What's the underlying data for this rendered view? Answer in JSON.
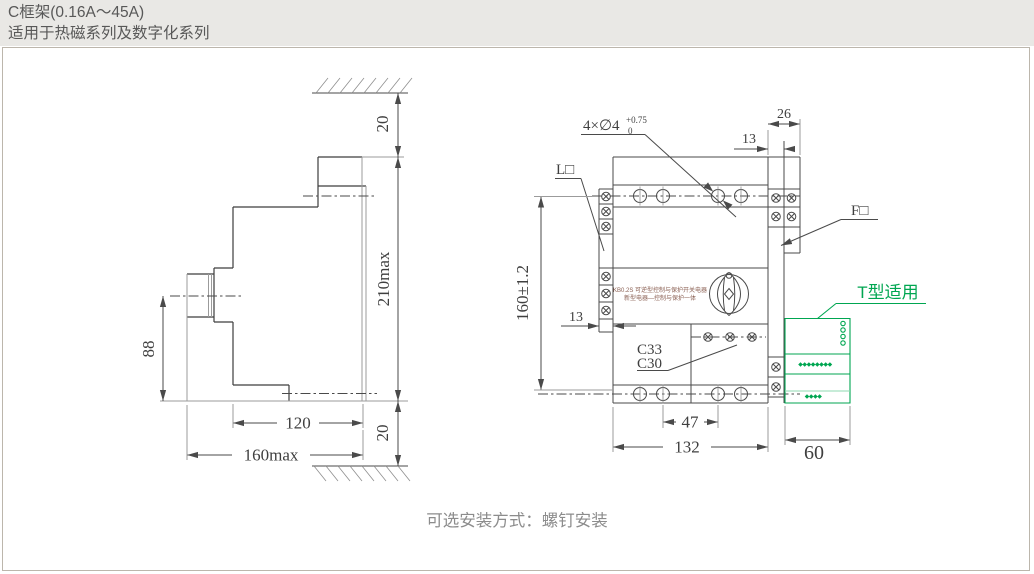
{
  "header": {
    "title": "C框架(0.16A～45A)",
    "subtitle": "适用于热磁系列及数字化系列"
  },
  "caption": "可选安装方式：螺钉安装",
  "colors": {
    "line": "#4a4a4a",
    "line_light": "#9b9b9b",
    "green_accent": "#00a651",
    "header_bg": "#e9e8e5",
    "header_text": "#585858",
    "panel_border": "#bcb6ac",
    "caption_text": "#8c8c8c"
  },
  "side_view": {
    "dim_top_gap": "20",
    "dim_bottom_gap": "20",
    "dim_height": "210max",
    "dim_width": "160max",
    "dim_upper_width": "120",
    "dim_center_height": "88"
  },
  "front_view": {
    "hole_label_prefix": "4×∅4",
    "hole_label_sup": "+0.75",
    "hole_label_sub": "0",
    "label_l": "L□",
    "label_f": "F□",
    "label_c33": "C33",
    "label_c30": "C30",
    "label_t_type": "T型适用",
    "dim_width": "132",
    "dim_hole_span": "47",
    "dim_height": "160±1.2",
    "dim_side_unit_width": "60",
    "dim_f_width": "26",
    "dim_f_half": "13",
    "dim_terminal_offset": "13",
    "face_text_line1": "KB0.2S 可逆型控制与保护开关电器",
    "face_text_line2": "新型电器—控制与保护一体"
  }
}
